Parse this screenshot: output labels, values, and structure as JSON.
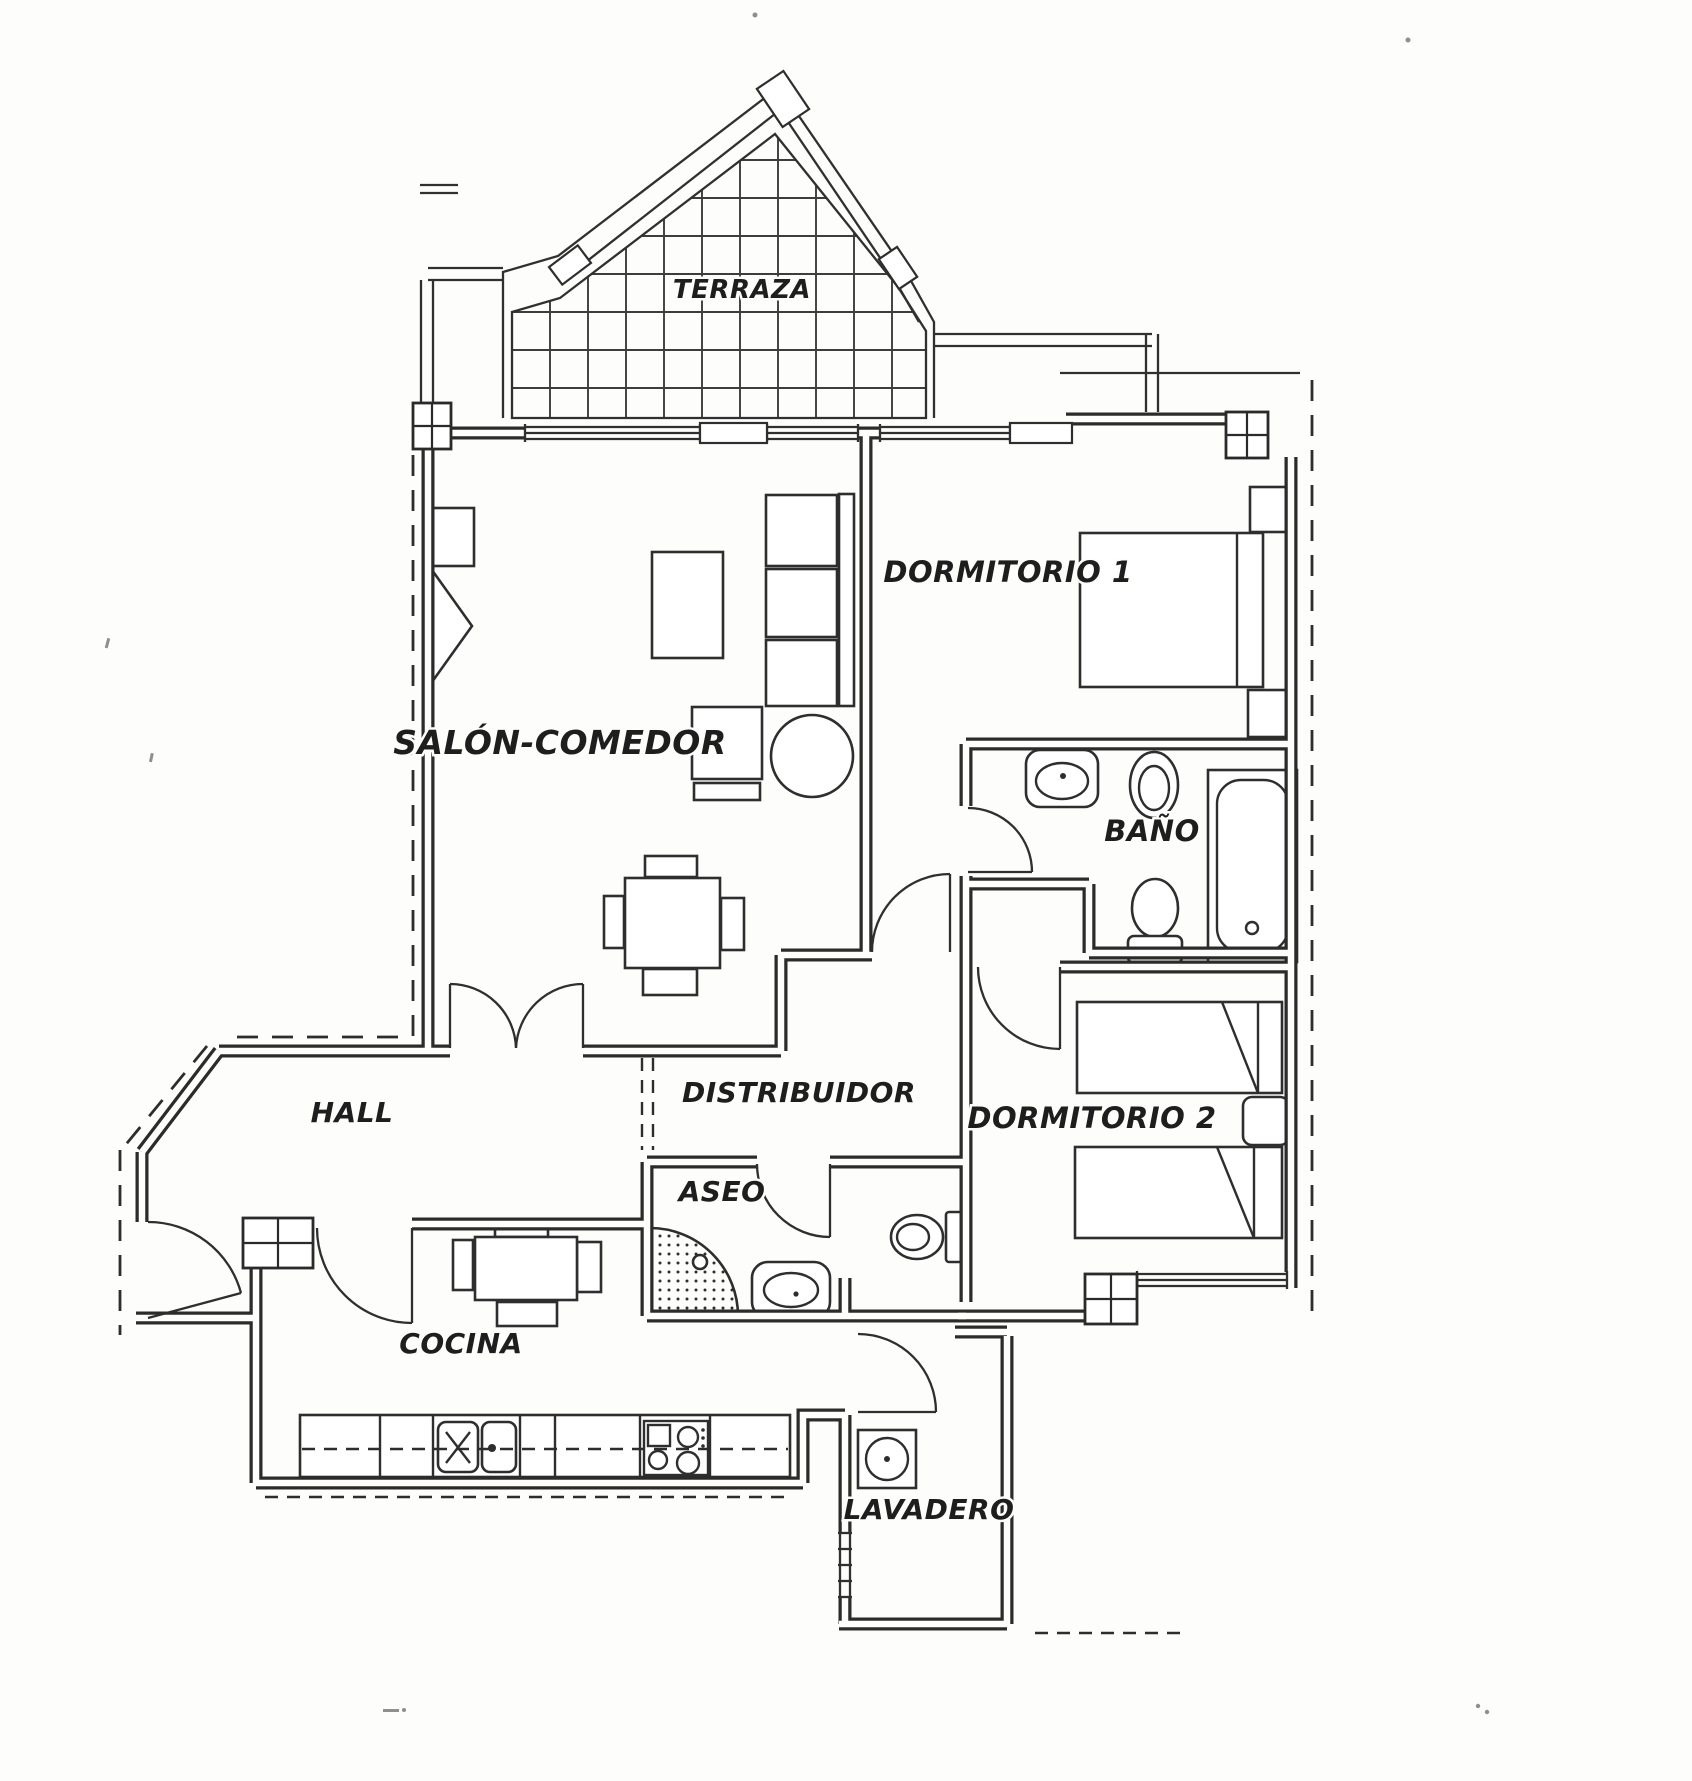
{
  "floor_plan": {
    "type": "apartment-floor-plan-scan",
    "rooms": [
      {
        "id": "terraza",
        "label": "TERRAZA"
      },
      {
        "id": "dormitorio-1",
        "label": "DORMITORIO 1"
      },
      {
        "id": "salon-comedor",
        "label": "SALÓN-COMEDOR"
      },
      {
        "id": "bano",
        "label": "BAÑO"
      },
      {
        "id": "hall",
        "label": "HALL"
      },
      {
        "id": "distribuidor",
        "label": "DISTRIBUIDOR"
      },
      {
        "id": "dormitorio-2",
        "label": "DORMITORIO 2"
      },
      {
        "id": "aseo",
        "label": "ASEO"
      },
      {
        "id": "cocina",
        "label": "COCINA"
      },
      {
        "id": "lavadero",
        "label": "LAVADERO"
      }
    ],
    "colors": {
      "paper": "#fdfdfb",
      "ink": "#2b2b2b"
    }
  }
}
